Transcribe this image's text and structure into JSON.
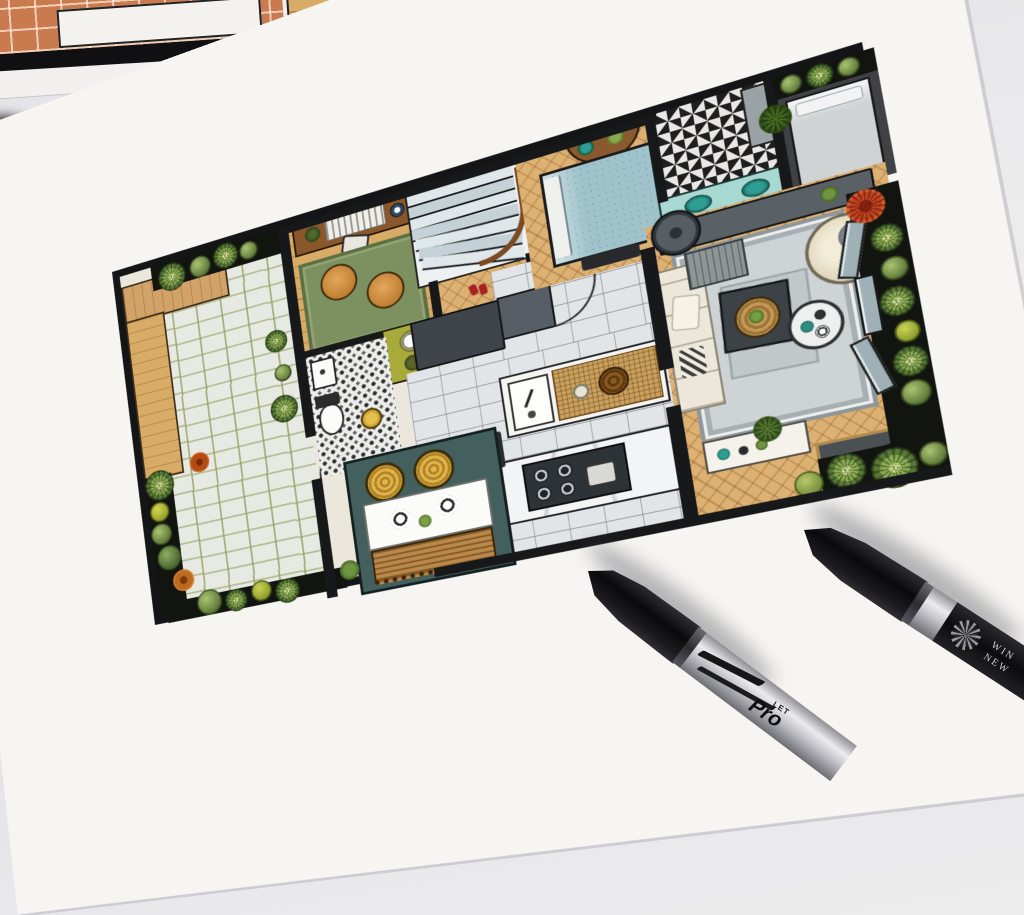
{
  "scene": {
    "description": "Photograph of a hand-drawn interior floor plan rendered with markers, lying on a desk with two black marker pens",
    "desk_color": "#e6e6ea",
    "paper_color": "#f6f5f2",
    "ink_wall_color": "#17181a"
  },
  "upper_sheet": {
    "name": "second floor-plan sheet, partially visible",
    "floor_tile_color": "#c97a4e"
  },
  "floor_plan": {
    "rooms": [
      {
        "id": "garden-patio",
        "floor": "stone pavers with planted borders and timber deck"
      },
      {
        "id": "study",
        "floor": "wood planks, green rug, two tan chairs, desk"
      },
      {
        "id": "wc",
        "floor": "black-white pebble mosaic, toilet, basin, stool"
      },
      {
        "id": "hallway-stairs",
        "floor": "wood, curved stair with blue-grey treads"
      },
      {
        "id": "kitchen",
        "floor": "grey brick tiles, island with sink, marble counter with hob"
      },
      {
        "id": "dining-nook",
        "floor": "teal banquette, white table, rattan stools, woven bench"
      },
      {
        "id": "bedroom",
        "floor": "herringbone wood, blue quilted bed"
      },
      {
        "id": "bathroom",
        "floor": "black-white patterned tile, teal double vanity"
      },
      {
        "id": "bedroom-2",
        "floor": "grey bed in dark surround"
      },
      {
        "id": "living-room",
        "floor": "herringbone wood, grey bordered rug, cream sofa, papasan chair"
      },
      {
        "id": "terrace",
        "floor": "faceted bay glazing with succulent planting"
      }
    ],
    "palette": {
      "wood": "#d8ab66",
      "herringbone": "#dcb172",
      "pavers": "#e7e9e3",
      "rug_green": "#7d9060",
      "rug_grey": "#ced3d5",
      "bed_blue": "#9fc2cb",
      "vanity_teal": "#a8d8d2",
      "dining_teal": "#44605e",
      "stool_yellow": "#d9a93f"
    }
  },
  "pens": {
    "left": {
      "name": "bullet-cap marker",
      "cap_color": "#0b0b0d",
      "barrel_color": "#c9c9ce",
      "text_small": "LET",
      "text_large": "Pro"
    },
    "right": {
      "name": "bullet-cap marker",
      "cap_color": "#0b0b0d",
      "barrel_color": "#c9c9ce",
      "label_line1": "WIN",
      "label_line2": "NEW"
    }
  }
}
